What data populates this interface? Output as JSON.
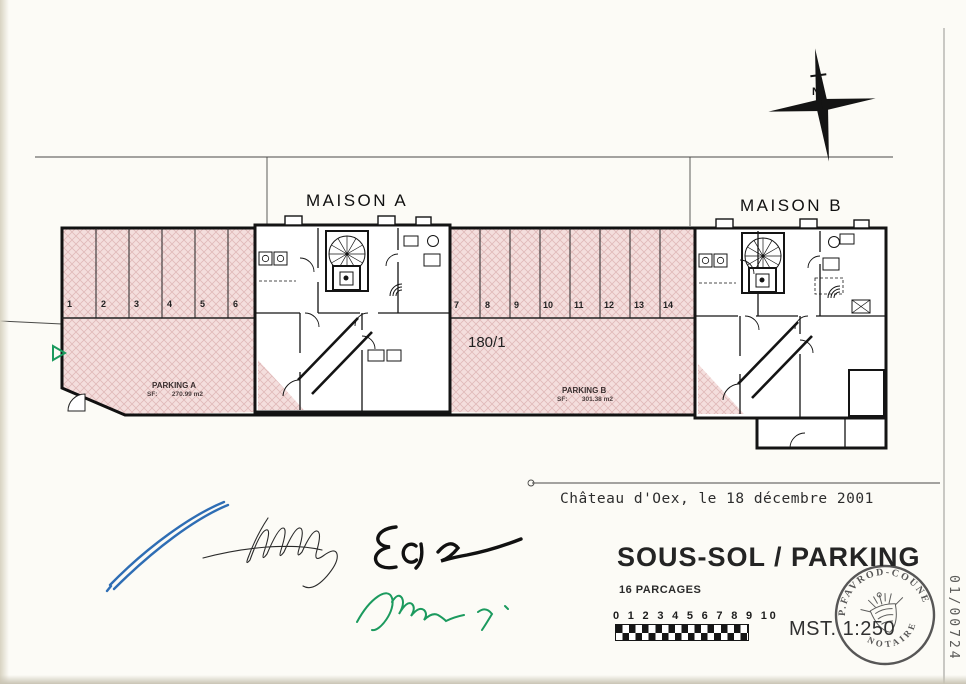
{
  "drawing": {
    "maison_a": "MAISON A",
    "maison_b": "MAISON B",
    "parcel_number": "180/1",
    "north_label": "N",
    "parking_a": {
      "name": "PARKING A",
      "area": "SF:        270.99 m2"
    },
    "parking_b": {
      "name": "PARKING B",
      "area": "SF:        301.38 m2"
    },
    "spaces": [
      "1",
      "2",
      "3",
      "4",
      "5",
      "6",
      "7",
      "8",
      "9",
      "10",
      "11",
      "12",
      "13",
      "14"
    ]
  },
  "footer": {
    "date_line": "Château d'Oex, le 18 décembre 2001",
    "title": "SOUS-SOL / PARKING",
    "subtitle": "16 PARCAGES",
    "scale_ruler_numbers": "0 1 2 3 4 5 6 7 8 9 10",
    "scale_text": "MST. 1:250",
    "archive_number": "01/00724"
  },
  "stamp": {
    "arc_top": "P.FAVROD-COUNE",
    "arc_bottom": "NOTAIRE"
  },
  "colors": {
    "parking_fill": "#f4dedd",
    "hatch_line": "#c98f8f",
    "signature_blue": "#2e6db4",
    "signature_green": "#1b9a5e",
    "ink": "#1c1c1c"
  }
}
